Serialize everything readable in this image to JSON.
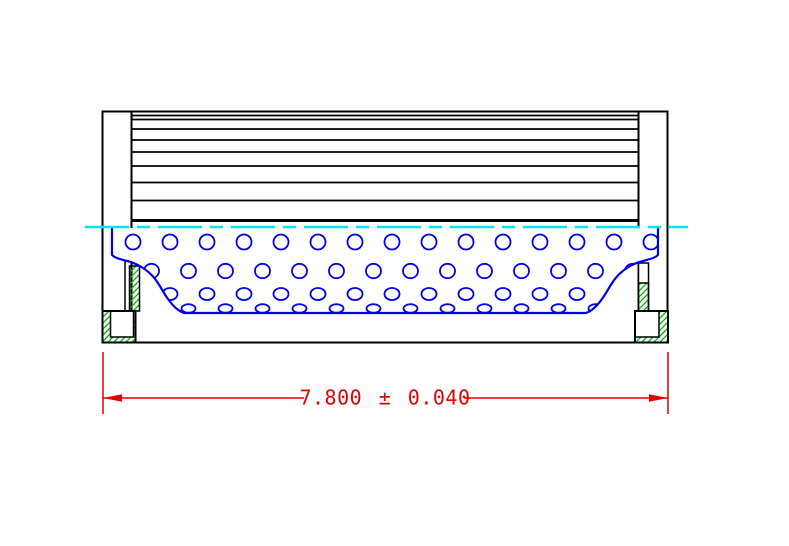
{
  "drawing": {
    "kind": "filter-element-cross-section",
    "dimension": {
      "label": "7.800 ± 0.040",
      "value": "7.800",
      "tolerance": "0.040"
    },
    "colors": {
      "outline": "#000000",
      "core": "#0000ee",
      "centerline": "#00e5ff",
      "dimension": "#e60000",
      "hatch": "#00b400",
      "background": "#ffffff"
    },
    "pleat_lines_y": [
      115.5,
      119.5,
      129,
      140,
      152,
      166,
      182.5,
      200.5
    ],
    "perforation_rows": [
      {
        "cy": 242,
        "rx": 7.5,
        "ry": 7.5,
        "start_x": 133,
        "spacing": 37,
        "count": 15
      },
      {
        "cy": 271,
        "rx": 7.5,
        "ry": 7.2,
        "start_x": 151.5,
        "spacing": 37,
        "count": 14
      },
      {
        "cy": 294,
        "rx": 7.5,
        "ry": 6.0,
        "start_x": 133,
        "spacing": 37,
        "count": 15
      },
      {
        "cy": 308.5,
        "rx": 7.0,
        "ry": 4.3,
        "start_x": 151.5,
        "spacing": 37,
        "count": 14
      }
    ]
  }
}
